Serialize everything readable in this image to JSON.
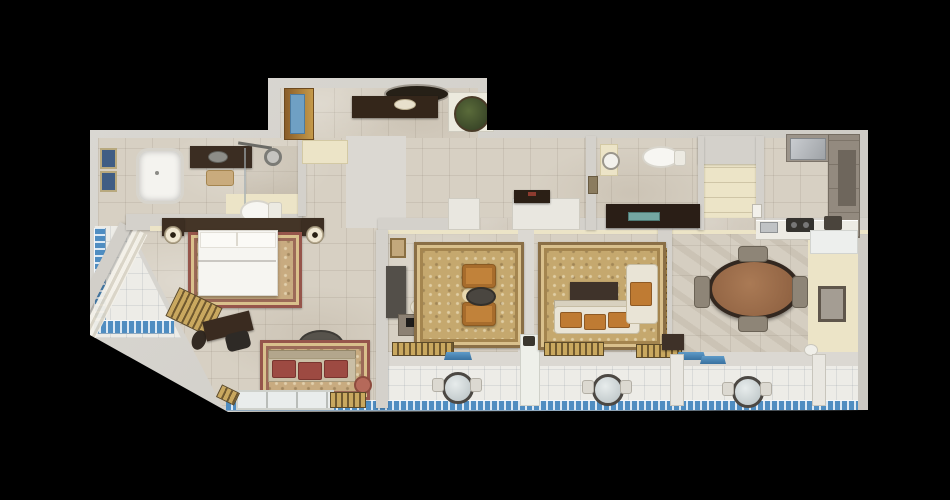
{
  "scene": {
    "kind": "3D rendered top-down floor plan",
    "subject": "Luxury hotel suite with bedroom, two sitting rooms, dining room, kitchen and wrap balconies",
    "background": "#000000"
  },
  "palette": {
    "background": "#000000",
    "wall_gray": "#d4d1cb",
    "inner_wall_cream": "#ece4c7",
    "marble_floor": "#d7d0c3",
    "balcony_tile": "#edece7",
    "balcony_blue": "#4f8dc1",
    "rug_gold": "#c5a86e",
    "rug_border_red": "#96554b",
    "dark_wood": "#3a2b20",
    "gold_slats": "#c9a85f",
    "upholstery_orange": "#c1823a",
    "cushion_red": "#9d4a42",
    "linen_white": "#f6f5f1",
    "cabinet_taupe": "#9a9186"
  },
  "rooms": {
    "entry_hall": "Entry Hall",
    "foyer": "Foyer Corridor",
    "master_bathroom": "Master Bathroom",
    "walk_in_closet": "Walk-in Closet",
    "guest_bathroom": "Guest Bathroom",
    "storage_niche": "Storage Niche",
    "kitchen": "Kitchen",
    "master_bedroom": "Master Bedroom",
    "side_balcony": "Side Balcony",
    "living_room": "Living Room",
    "family_room": "Family Sitting Room",
    "dining_room": "Dining Room",
    "rear_balcony": "Rear Balcony"
  },
  "furniture": {
    "entry_door": "Entry Door",
    "console_table": "Console Table",
    "wall_mirror": "Oval Wall Mirror",
    "potted_plant": "Potted Plant on Stand",
    "bathtub": "Bathtub",
    "vanity": "Dark Vanity Counter",
    "shower": "Walk-in Shower",
    "toilet": "Toilet",
    "wall_art": "Framed Wall Art",
    "stool": "Bath Stool",
    "closet_shelf": "Closet Shelving",
    "basin_console": "Basin Console",
    "upper_cabinets": "Kitchen Cabinets",
    "fridge": "Steel Appliance",
    "counter": "Kitchen Counter",
    "cooktop": "Cooktop",
    "kitchen_sink": "Kitchen Sink",
    "bed": "Double Bed with White Linens",
    "headboard": "Headboard",
    "nightstand": "Nightstand",
    "table_lamp": "Table Lamp",
    "bed_rug": "Ornate Bedside Rug",
    "writing_desk": "Writing Desk",
    "desk_chair": "Desk Chair",
    "ottoman": "Ottoman",
    "bench": "Slatted Bench",
    "bedroom_sofa": "Settee with Red Cushions",
    "round_table": "Round Side Table",
    "sheer_curtain": "Sheer Curtain Wall",
    "balcony_door": "Glass Balcony Door",
    "threshold": "Wood Slat Threshold",
    "tv_cabinet": "TV Cabinet",
    "armchair": "Orange Armchair",
    "coffee_table": "Round Coffee Table",
    "living_rug": "Gold Medallion Rug",
    "sofa": "Sofa with Orange Cushions",
    "lounge_chair": "Lounge Chair",
    "media_table": "Media Table",
    "dining_table": "Oval Dining Table",
    "dining_chair": "Dining Chair",
    "sideboard": "White Wall Cabinet",
    "bistro_table": "Round Bistro Table",
    "balcony_chair": "Balcony Chair",
    "mosaic_border": "Blue Mosaic Tile Border",
    "partition": "Balcony Partition",
    "pedestal": "Pedestal with Ornament",
    "door_mat": "Blue Door Mat"
  }
}
